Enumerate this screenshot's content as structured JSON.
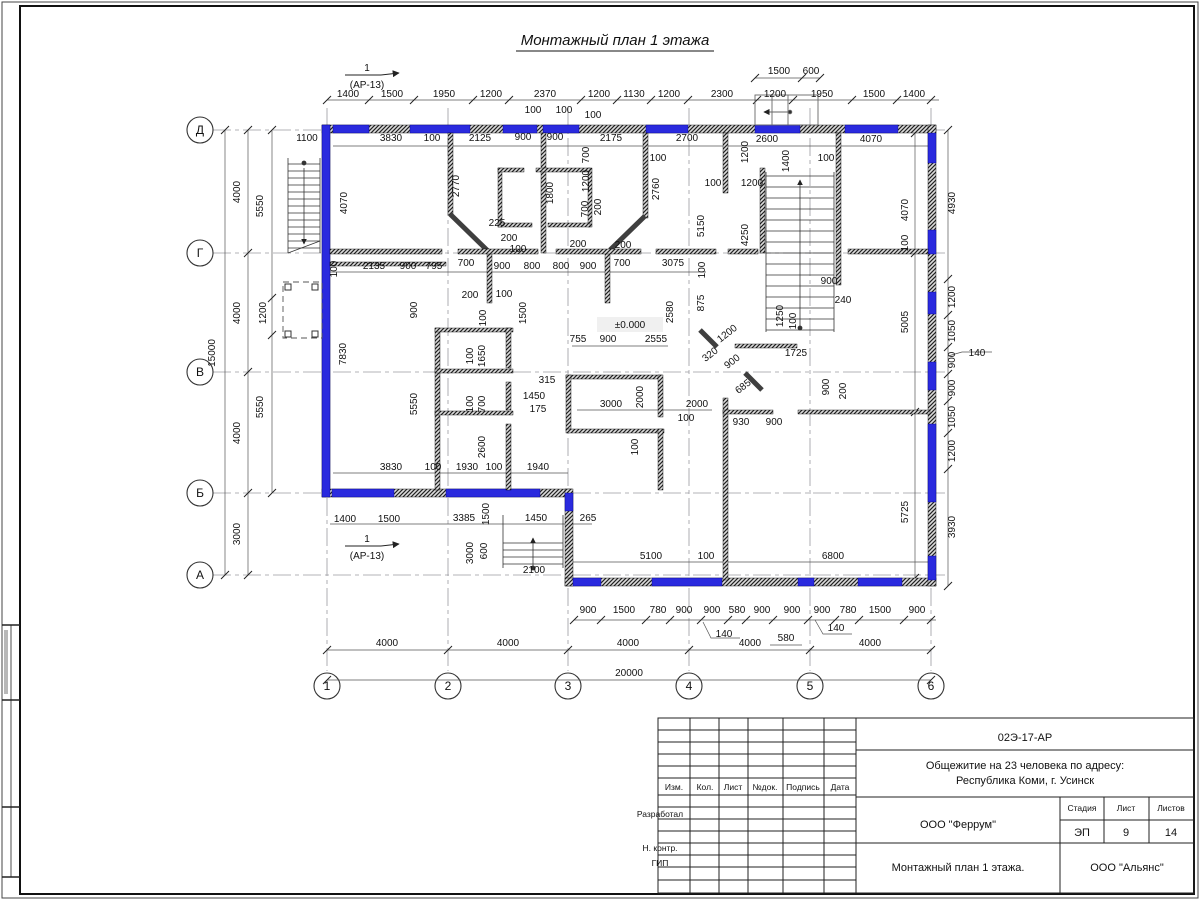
{
  "sheet": {
    "title": "Монтажный план 1 этажа"
  },
  "titleblock": {
    "doc_code": "02Э-17-АР",
    "project_line1": "Общежитие на 23 человека по адресу:",
    "project_line2": "Республика Коми, г. Усинск",
    "org": "ООО \"Феррум\"",
    "org2": "ООО \"Альянс\"",
    "drawing_title": "Монтажный план 1 этажа.",
    "stage_label": "Стадия",
    "sheet_label": "Лист",
    "sheets_label": "Листов",
    "stage": "ЭП",
    "sheet_num": "9",
    "sheets_total": "14",
    "cols": [
      "Изм.",
      "Кол.",
      "Лист",
      "№док.",
      "Подпись",
      "Дата"
    ],
    "rows": [
      "Разработал",
      "Н. контр.",
      "ГИП"
    ]
  },
  "plan": {
    "level_mark": "±0.000",
    "axes": {
      "rows": [
        {
          "label": "Д",
          "y": 130
        },
        {
          "label": "Г",
          "y": 253
        },
        {
          "label": "В",
          "y": 372
        },
        {
          "label": "Б",
          "y": 493
        },
        {
          "label": "А",
          "y": 575
        }
      ],
      "cols": [
        {
          "label": "1",
          "x": 327
        },
        {
          "label": "2",
          "x": 448
        },
        {
          "label": "3",
          "x": 568
        },
        {
          "label": "4",
          "x": 689
        },
        {
          "label": "5",
          "x": 810
        },
        {
          "label": "6",
          "x": 931
        }
      ]
    },
    "section_markers": [
      {
        "num": "1",
        "ref": "(АР-13)",
        "x": 367,
        "y": 71
      },
      {
        "num": "1",
        "ref": "(АР-13)",
        "x": 367,
        "y": 542
      }
    ],
    "labels": [
      {
        "t": "1400",
        "x": 348,
        "y": 97
      },
      {
        "t": "1500",
        "x": 392,
        "y": 97
      },
      {
        "t": "1950",
        "x": 444,
        "y": 97
      },
      {
        "t": "1200",
        "x": 491,
        "y": 97
      },
      {
        "t": "2370",
        "x": 545,
        "y": 97
      },
      {
        "t": "1200",
        "x": 599,
        "y": 97
      },
      {
        "t": "1130",
        "x": 634,
        "y": 97
      },
      {
        "t": "1200",
        "x": 669,
        "y": 97
      },
      {
        "t": "2300",
        "x": 722,
        "y": 97
      },
      {
        "t": "1200",
        "x": 775,
        "y": 97
      },
      {
        "t": "1950",
        "x": 822,
        "y": 97
      },
      {
        "t": "1500",
        "x": 874,
        "y": 97
      },
      {
        "t": "1400",
        "x": 914,
        "y": 97
      },
      {
        "t": "1500",
        "x": 779,
        "y": 74
      },
      {
        "t": "600",
        "x": 811,
        "y": 74
      },
      {
        "t": "1200",
        "x": 748,
        "y": 152,
        "r": -90
      },
      {
        "t": "100",
        "x": 533,
        "y": 113
      },
      {
        "t": "100",
        "x": 564,
        "y": 113
      },
      {
        "t": "100",
        "x": 593,
        "y": 118
      },
      {
        "t": "1100",
        "x": 307,
        "y": 141
      },
      {
        "t": "3830",
        "x": 391,
        "y": 141
      },
      {
        "t": "100",
        "x": 432,
        "y": 141
      },
      {
        "t": "2125",
        "x": 480,
        "y": 141
      },
      {
        "t": "900",
        "x": 523,
        "y": 140
      },
      {
        "t": "900",
        "x": 555,
        "y": 140
      },
      {
        "t": "2175",
        "x": 611,
        "y": 141
      },
      {
        "t": "2700",
        "x": 687,
        "y": 141
      },
      {
        "t": "2600",
        "x": 767,
        "y": 142
      },
      {
        "t": "4070",
        "x": 871,
        "y": 142
      },
      {
        "t": "100",
        "x": 658,
        "y": 161
      },
      {
        "t": "100",
        "x": 713,
        "y": 186
      },
      {
        "t": "1200",
        "x": 752,
        "y": 186
      },
      {
        "t": "100",
        "x": 826,
        "y": 161
      },
      {
        "t": "4070",
        "x": 347,
        "y": 203,
        "r": -90
      },
      {
        "t": "2770",
        "x": 459,
        "y": 186,
        "r": -90
      },
      {
        "t": "1800",
        "x": 553,
        "y": 193,
        "r": -90
      },
      {
        "t": "700",
        "x": 589,
        "y": 155,
        "r": -90
      },
      {
        "t": "1200",
        "x": 589,
        "y": 181,
        "r": -90
      },
      {
        "t": "700",
        "x": 588,
        "y": 209,
        "r": -90
      },
      {
        "t": "200",
        "x": 601,
        "y": 207,
        "r": -90
      },
      {
        "t": "2760",
        "x": 659,
        "y": 189,
        "r": -90
      },
      {
        "t": "5150",
        "x": 704,
        "y": 226,
        "r": -90
      },
      {
        "t": "4250",
        "x": 748,
        "y": 235,
        "r": -90
      },
      {
        "t": "1400",
        "x": 789,
        "y": 161,
        "r": -90
      },
      {
        "t": "4070",
        "x": 908,
        "y": 210,
        "r": -90
      },
      {
        "t": "100",
        "x": 908,
        "y": 243,
        "r": -90
      },
      {
        "t": "225",
        "x": 497,
        "y": 226
      },
      {
        "t": "200",
        "x": 509,
        "y": 241
      },
      {
        "t": "100",
        "x": 518,
        "y": 252
      },
      {
        "t": "200",
        "x": 578,
        "y": 247
      },
      {
        "t": "200",
        "x": 623,
        "y": 248
      },
      {
        "t": "100",
        "x": 337,
        "y": 269,
        "r": -90
      },
      {
        "t": "2135",
        "x": 374,
        "y": 269
      },
      {
        "t": "900",
        "x": 408,
        "y": 269
      },
      {
        "t": "795",
        "x": 434,
        "y": 269
      },
      {
        "t": "700",
        "x": 466,
        "y": 266
      },
      {
        "t": "900",
        "x": 502,
        "y": 269
      },
      {
        "t": "800",
        "x": 532,
        "y": 269
      },
      {
        "t": "800",
        "x": 561,
        "y": 269
      },
      {
        "t": "900",
        "x": 588,
        "y": 269
      },
      {
        "t": "700",
        "x": 622,
        "y": 266
      },
      {
        "t": "3075",
        "x": 673,
        "y": 266
      },
      {
        "t": "100",
        "x": 705,
        "y": 270,
        "r": -90
      },
      {
        "t": "875",
        "x": 704,
        "y": 303,
        "r": -90
      },
      {
        "t": "2580",
        "x": 673,
        "y": 312,
        "r": -90
      },
      {
        "t": "1200",
        "x": 729,
        "y": 336,
        "r": -38
      },
      {
        "t": "320",
        "x": 712,
        "y": 357,
        "r": -38
      },
      {
        "t": "900",
        "x": 734,
        "y": 364,
        "r": -38
      },
      {
        "t": "685",
        "x": 745,
        "y": 389,
        "r": -38
      },
      {
        "t": "1725",
        "x": 796,
        "y": 356
      },
      {
        "t": "1250",
        "x": 783,
        "y": 316,
        "r": -90
      },
      {
        "t": "100",
        "x": 796,
        "y": 321,
        "r": -90
      },
      {
        "t": "900",
        "x": 829,
        "y": 284
      },
      {
        "t": "240",
        "x": 843,
        "y": 303
      },
      {
        "t": "900",
        "x": 829,
        "y": 387,
        "r": -90
      },
      {
        "t": "200",
        "x": 846,
        "y": 391,
        "r": -90
      },
      {
        "t": "5005",
        "x": 908,
        "y": 322,
        "r": -90
      },
      {
        "t": "930",
        "x": 741,
        "y": 425
      },
      {
        "t": "900",
        "x": 774,
        "y": 425
      },
      {
        "t": "755",
        "x": 578,
        "y": 342
      },
      {
        "t": "900",
        "x": 608,
        "y": 342
      },
      {
        "t": "2555",
        "x": 656,
        "y": 342
      },
      {
        "t": "2000",
        "x": 643,
        "y": 397,
        "r": -90
      },
      {
        "t": "3000",
        "x": 611,
        "y": 407
      },
      {
        "t": "2000",
        "x": 697,
        "y": 407
      },
      {
        "t": "100",
        "x": 686,
        "y": 421
      },
      {
        "t": "100",
        "x": 638,
        "y": 447,
        "r": -90
      },
      {
        "t": "900",
        "x": 417,
        "y": 310,
        "r": -90
      },
      {
        "t": "200",
        "x": 470,
        "y": 298
      },
      {
        "t": "100",
        "x": 504,
        "y": 297
      },
      {
        "t": "1500",
        "x": 526,
        "y": 313,
        "r": -90
      },
      {
        "t": "100",
        "x": 486,
        "y": 318,
        "r": -90
      },
      {
        "t": "1650",
        "x": 485,
        "y": 356,
        "r": -90
      },
      {
        "t": "100",
        "x": 473,
        "y": 356,
        "r": -90
      },
      {
        "t": "700",
        "x": 485,
        "y": 404,
        "r": -90
      },
      {
        "t": "100",
        "x": 473,
        "y": 404,
        "r": -90
      },
      {
        "t": "315",
        "x": 547,
        "y": 383
      },
      {
        "t": "1450",
        "x": 534,
        "y": 399
      },
      {
        "t": "175",
        "x": 538,
        "y": 412
      },
      {
        "t": "2600",
        "x": 485,
        "y": 447,
        "r": -90
      },
      {
        "t": "7830",
        "x": 346,
        "y": 354,
        "r": -90
      },
      {
        "t": "5550",
        "x": 417,
        "y": 404,
        "r": -90
      },
      {
        "t": "3830",
        "x": 391,
        "y": 470
      },
      {
        "t": "100",
        "x": 433,
        "y": 470
      },
      {
        "t": "1930",
        "x": 467,
        "y": 470
      },
      {
        "t": "100",
        "x": 494,
        "y": 470
      },
      {
        "t": "1940",
        "x": 538,
        "y": 470
      },
      {
        "t": "1400",
        "x": 345,
        "y": 522
      },
      {
        "t": "1500",
        "x": 389,
        "y": 522
      },
      {
        "t": "3385",
        "x": 464,
        "y": 521
      },
      {
        "t": "1500",
        "x": 489,
        "y": 514,
        "r": -90
      },
      {
        "t": "1450",
        "x": 536,
        "y": 521
      },
      {
        "t": "265",
        "x": 588,
        "y": 521
      },
      {
        "t": "3000",
        "x": 473,
        "y": 553,
        "r": -90
      },
      {
        "t": "600",
        "x": 487,
        "y": 551,
        "r": -90
      },
      {
        "t": "2100",
        "x": 534,
        "y": 573
      },
      {
        "t": "5100",
        "x": 651,
        "y": 559
      },
      {
        "t": "100",
        "x": 706,
        "y": 559
      },
      {
        "t": "6800",
        "x": 833,
        "y": 559
      },
      {
        "t": "5725",
        "x": 908,
        "y": 512,
        "r": -90
      },
      {
        "t": "4000",
        "x": 240,
        "y": 192,
        "r": -90
      },
      {
        "t": "4000",
        "x": 240,
        "y": 313,
        "r": -90
      },
      {
        "t": "4000",
        "x": 240,
        "y": 433,
        "r": -90
      },
      {
        "t": "3000",
        "x": 240,
        "y": 534,
        "r": -90
      },
      {
        "t": "15000",
        "x": 215,
        "y": 353,
        "r": -90
      },
      {
        "t": "5550",
        "x": 263,
        "y": 206,
        "r": -90
      },
      {
        "t": "1200",
        "x": 266,
        "y": 313,
        "r": -90
      },
      {
        "t": "5550",
        "x": 263,
        "y": 407,
        "r": -90
      },
      {
        "t": "4930",
        "x": 955,
        "y": 203,
        "r": -90
      },
      {
        "t": "1200",
        "x": 955,
        "y": 297,
        "r": -90
      },
      {
        "t": "1050",
        "x": 955,
        "y": 331,
        "r": -90
      },
      {
        "t": "900",
        "x": 955,
        "y": 360,
        "r": -90
      },
      {
        "t": "140",
        "x": 977,
        "y": 356
      },
      {
        "t": "900",
        "x": 955,
        "y": 388,
        "r": -90
      },
      {
        "t": "1050",
        "x": 955,
        "y": 417,
        "r": -90
      },
      {
        "t": "1200",
        "x": 955,
        "y": 451,
        "r": -90
      },
      {
        "t": "3930",
        "x": 955,
        "y": 527,
        "r": -90
      },
      {
        "t": "900",
        "x": 588,
        "y": 613
      },
      {
        "t": "1500",
        "x": 624,
        "y": 613
      },
      {
        "t": "780",
        "x": 658,
        "y": 613
      },
      {
        "t": "900",
        "x": 684,
        "y": 613
      },
      {
        "t": "900",
        "x": 712,
        "y": 613
      },
      {
        "t": "580",
        "x": 737,
        "y": 613
      },
      {
        "t": "900",
        "x": 762,
        "y": 613
      },
      {
        "t": "900",
        "x": 792,
        "y": 613
      },
      {
        "t": "900",
        "x": 822,
        "y": 613
      },
      {
        "t": "780",
        "x": 848,
        "y": 613
      },
      {
        "t": "1500",
        "x": 880,
        "y": 613
      },
      {
        "t": "900",
        "x": 917,
        "y": 613
      },
      {
        "t": "140",
        "x": 724,
        "y": 637
      },
      {
        "t": "580",
        "x": 786,
        "y": 641
      },
      {
        "t": "140",
        "x": 836,
        "y": 631
      },
      {
        "t": "4000",
        "x": 387,
        "y": 646
      },
      {
        "t": "4000",
        "x": 508,
        "y": 646
      },
      {
        "t": "4000",
        "x": 628,
        "y": 646
      },
      {
        "t": "4000",
        "x": 750,
        "y": 646
      },
      {
        "t": "4000",
        "x": 870,
        "y": 646
      },
      {
        "t": "20000",
        "x": 629,
        "y": 676
      },
      {
        "t": "±0.000",
        "x": 630,
        "y": 328,
        "s": "box"
      }
    ]
  }
}
